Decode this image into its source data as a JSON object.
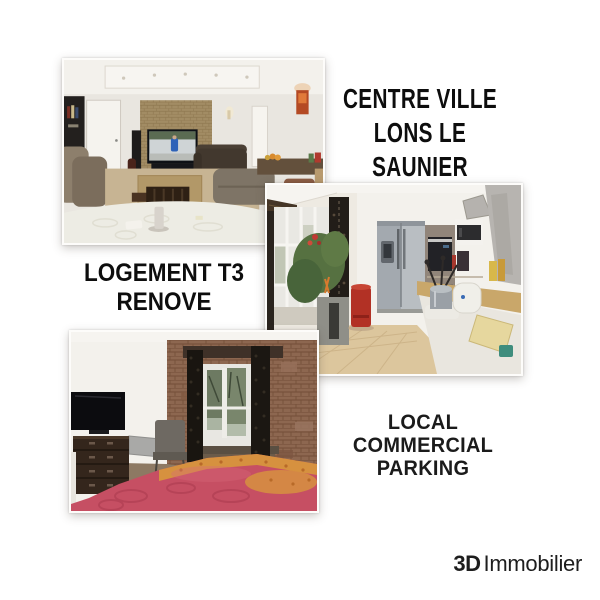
{
  "canvas": {
    "width": 600,
    "height": 600,
    "background": "#ffffff"
  },
  "headline": {
    "line1": "CENTRE VILLE",
    "line2": "LONS LE SAUNIER"
  },
  "labels": {
    "logement_line1": "LOGEMENT T3",
    "logement_line2": "RENOVE",
    "local_line1": "LOCAL COMMERCIAL",
    "local_line2": "PARKING"
  },
  "branding": {
    "prefix": "3D",
    "name": "Immobilier"
  },
  "colors": {
    "text": "#0d0d0d",
    "background": "#ffffff",
    "bed_pink": "#c64f63",
    "bed_orange": "#d6913f",
    "bin_red": "#b23125",
    "brick_bedroom": "#8d6750",
    "brick_living": "#a28c64",
    "stainless": "#b9bec2"
  }
}
